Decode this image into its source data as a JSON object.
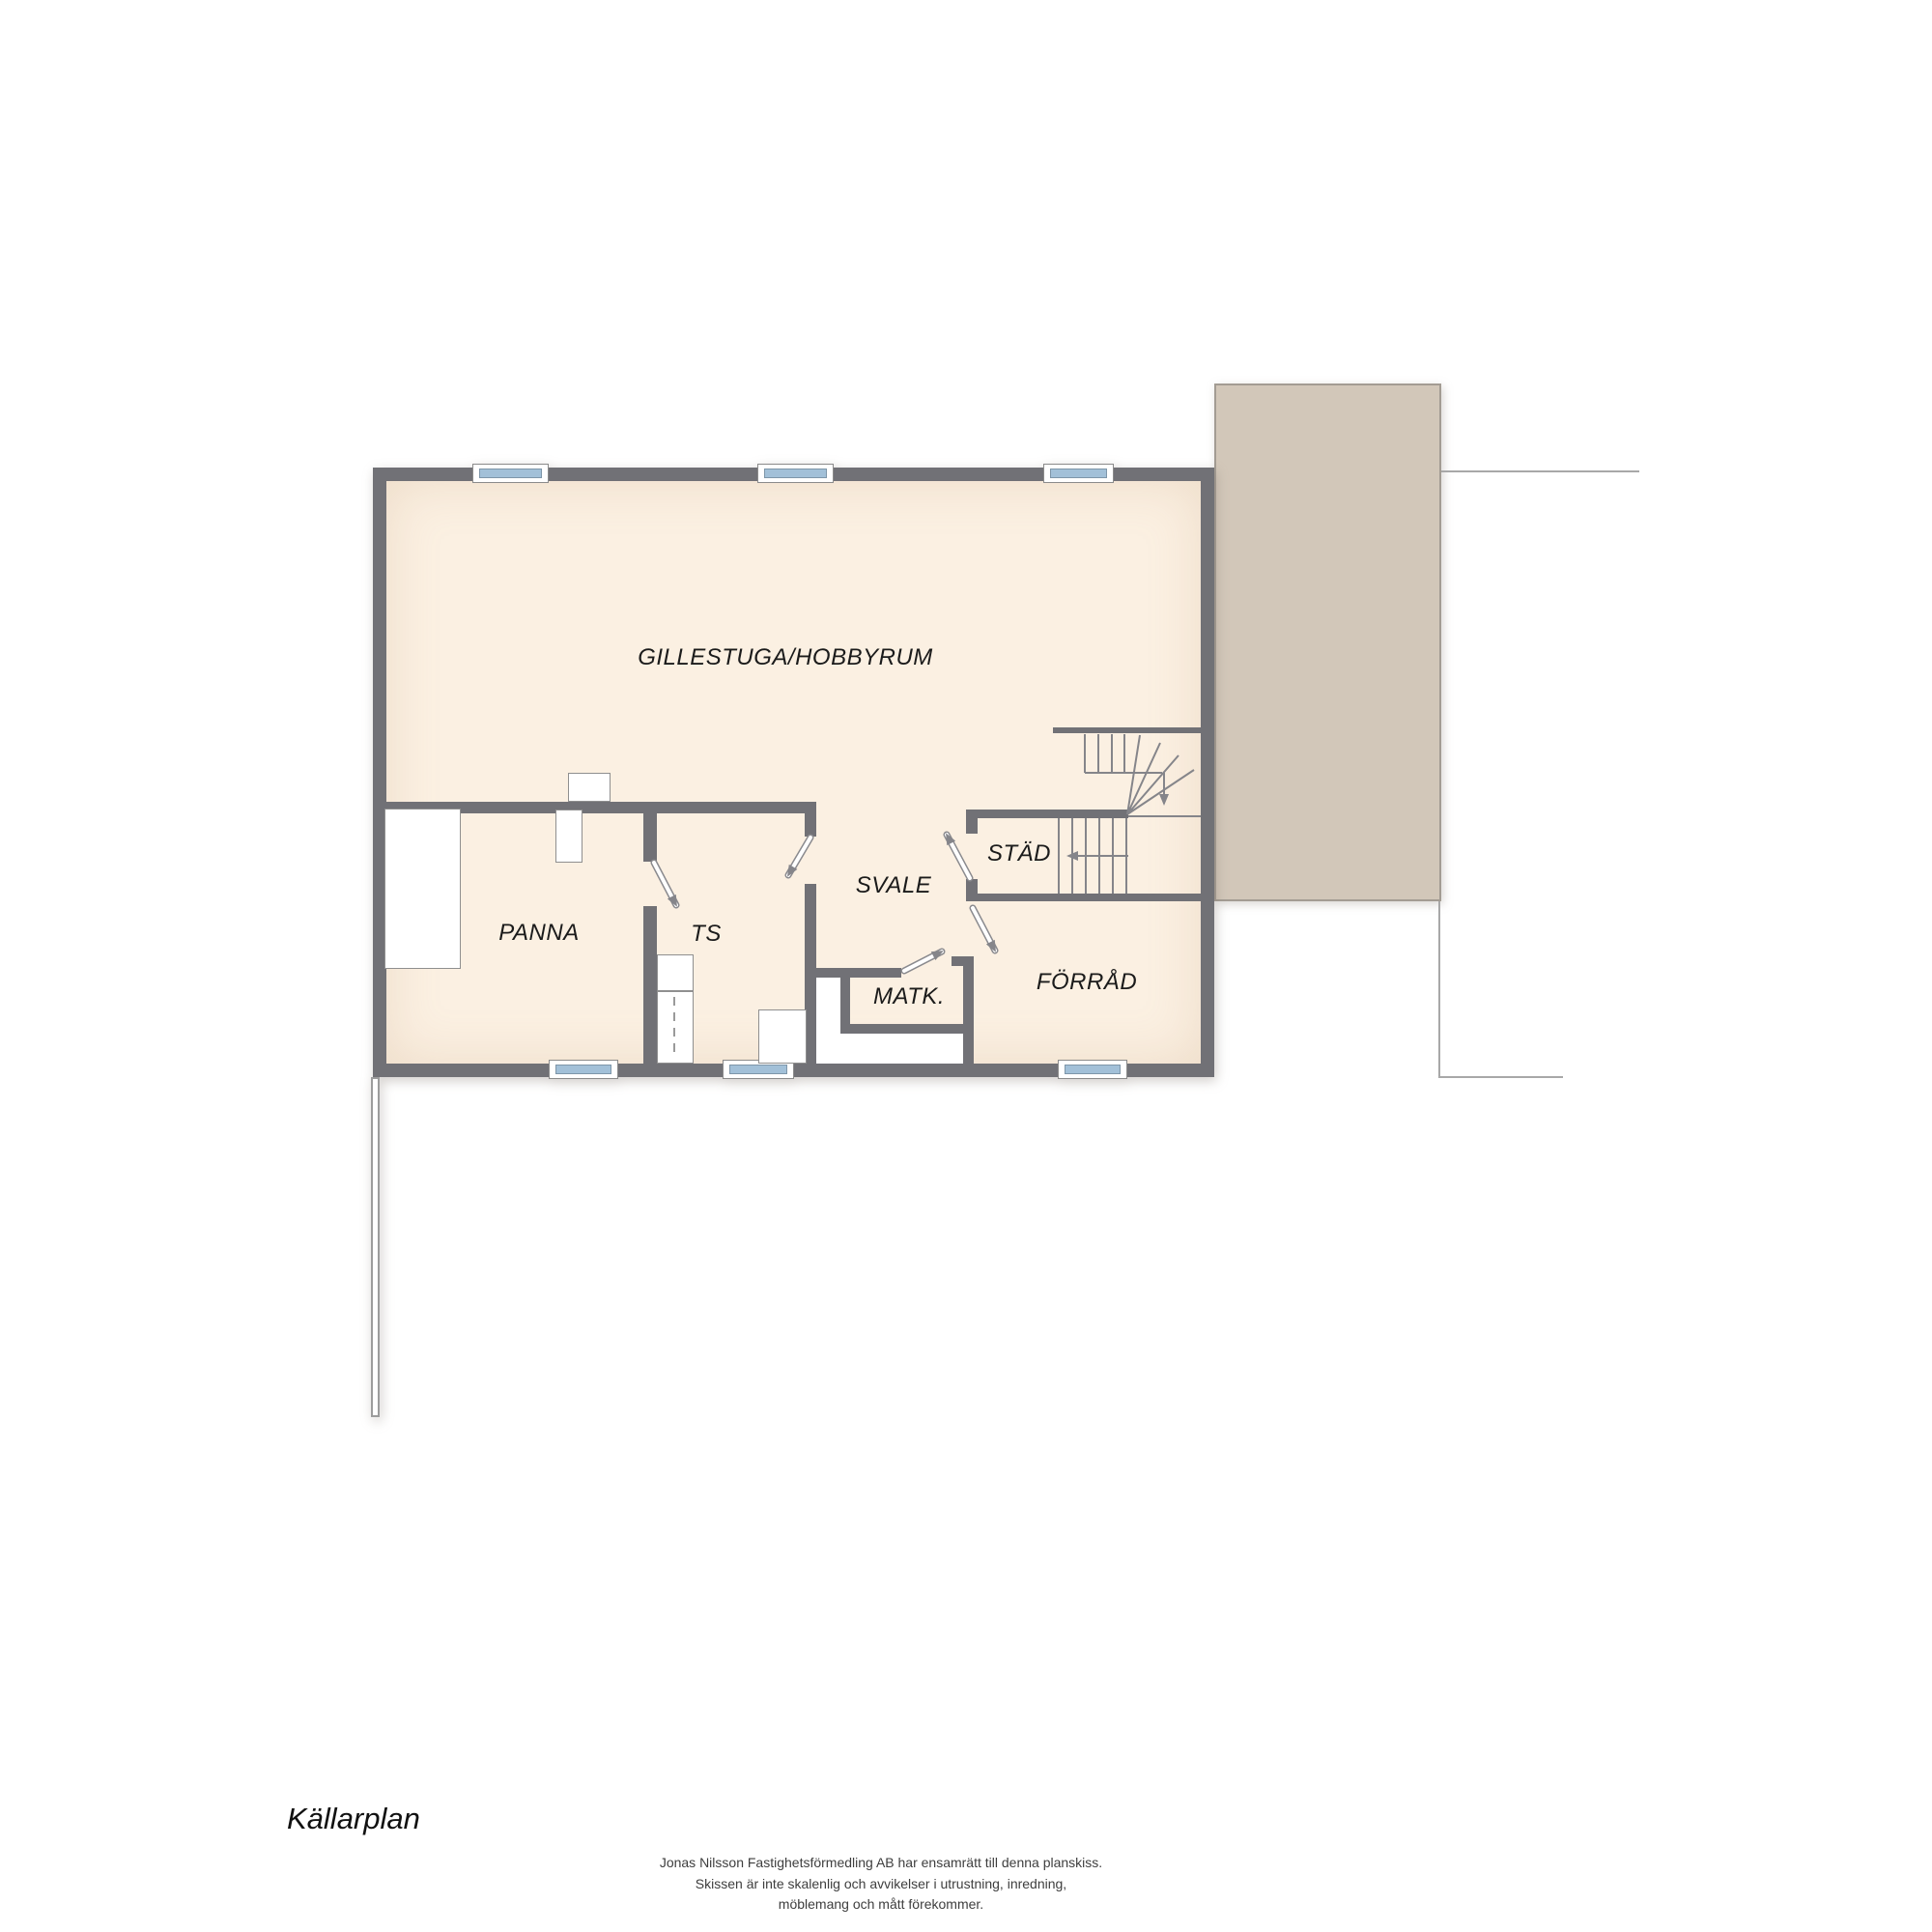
{
  "plan": {
    "title": "Källarplan",
    "rooms": [
      {
        "id": "gillestuga",
        "label": "GILLESTUGA/HOBBYRUM"
      },
      {
        "id": "panna",
        "label": "PANNA"
      },
      {
        "id": "ts",
        "label": "TS"
      },
      {
        "id": "svale",
        "label": "SVALE"
      },
      {
        "id": "stad",
        "label": "STÄD"
      },
      {
        "id": "matk",
        "label": "MATK."
      },
      {
        "id": "forrad",
        "label": "FÖRRÅD"
      }
    ],
    "colors": {
      "wall": "#717176",
      "floor": "#fbf0e2",
      "deck": "#d2c7b9",
      "deck_border": "#a39c93",
      "glass": "#a2c0d8",
      "line": "#85858a",
      "thin_line": "#a8a8a8",
      "fixture_border": "#8f8f8f",
      "label": "#1b1b1b",
      "footer_text": "#3e3e3e"
    }
  },
  "footer": {
    "line1": "Jonas Nilsson Fastighetsförmedling AB har ensamrätt till denna planskiss.",
    "line2": "Skissen är inte skalenlig och avvikelser i utrustning, inredning,",
    "line3": "möblemang och mått förekommer."
  }
}
